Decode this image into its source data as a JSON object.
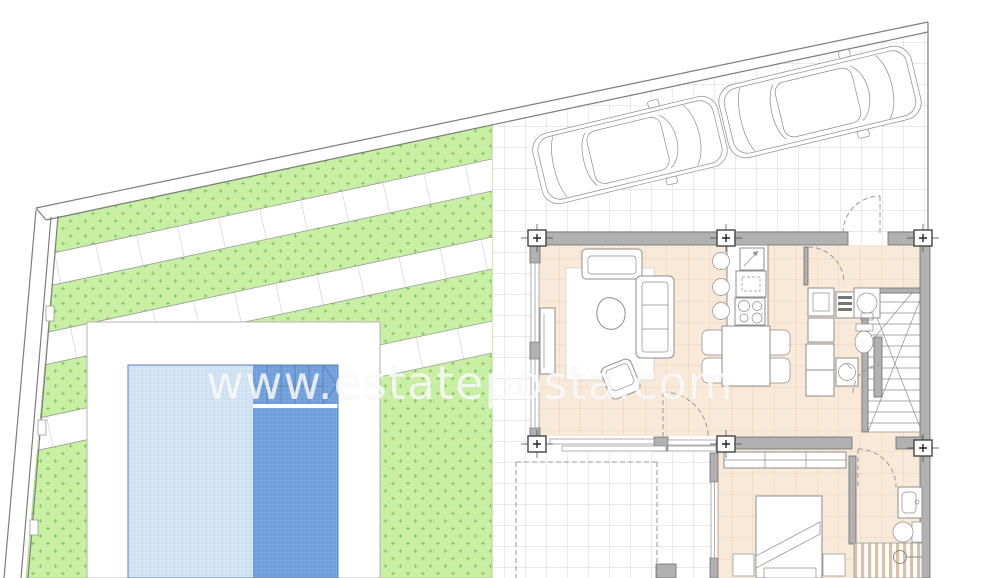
{
  "watermark": {
    "text": "www.estateposta.com"
  },
  "colors": {
    "grass": "#c9efa4",
    "grass_dot": "#82c95e",
    "paving_grid": "#c8c8c8",
    "boundary": "#7d7d7d",
    "floor": "#f9e9d9",
    "floor_grid": "#e7ccb2",
    "wall": "#b1b1b1",
    "wall_stroke": "#6e6e6e",
    "pool_light": "#cfe0f2",
    "pool_dark": "#6f9fdb",
    "pool_line": "#5c81b5",
    "deck_border": "#b3b3b3",
    "furniture_stroke": "#8d8d8d",
    "shower_stripe": "#d9c1a7",
    "watermark_color": "rgba(255,255,255,0.78)"
  }
}
